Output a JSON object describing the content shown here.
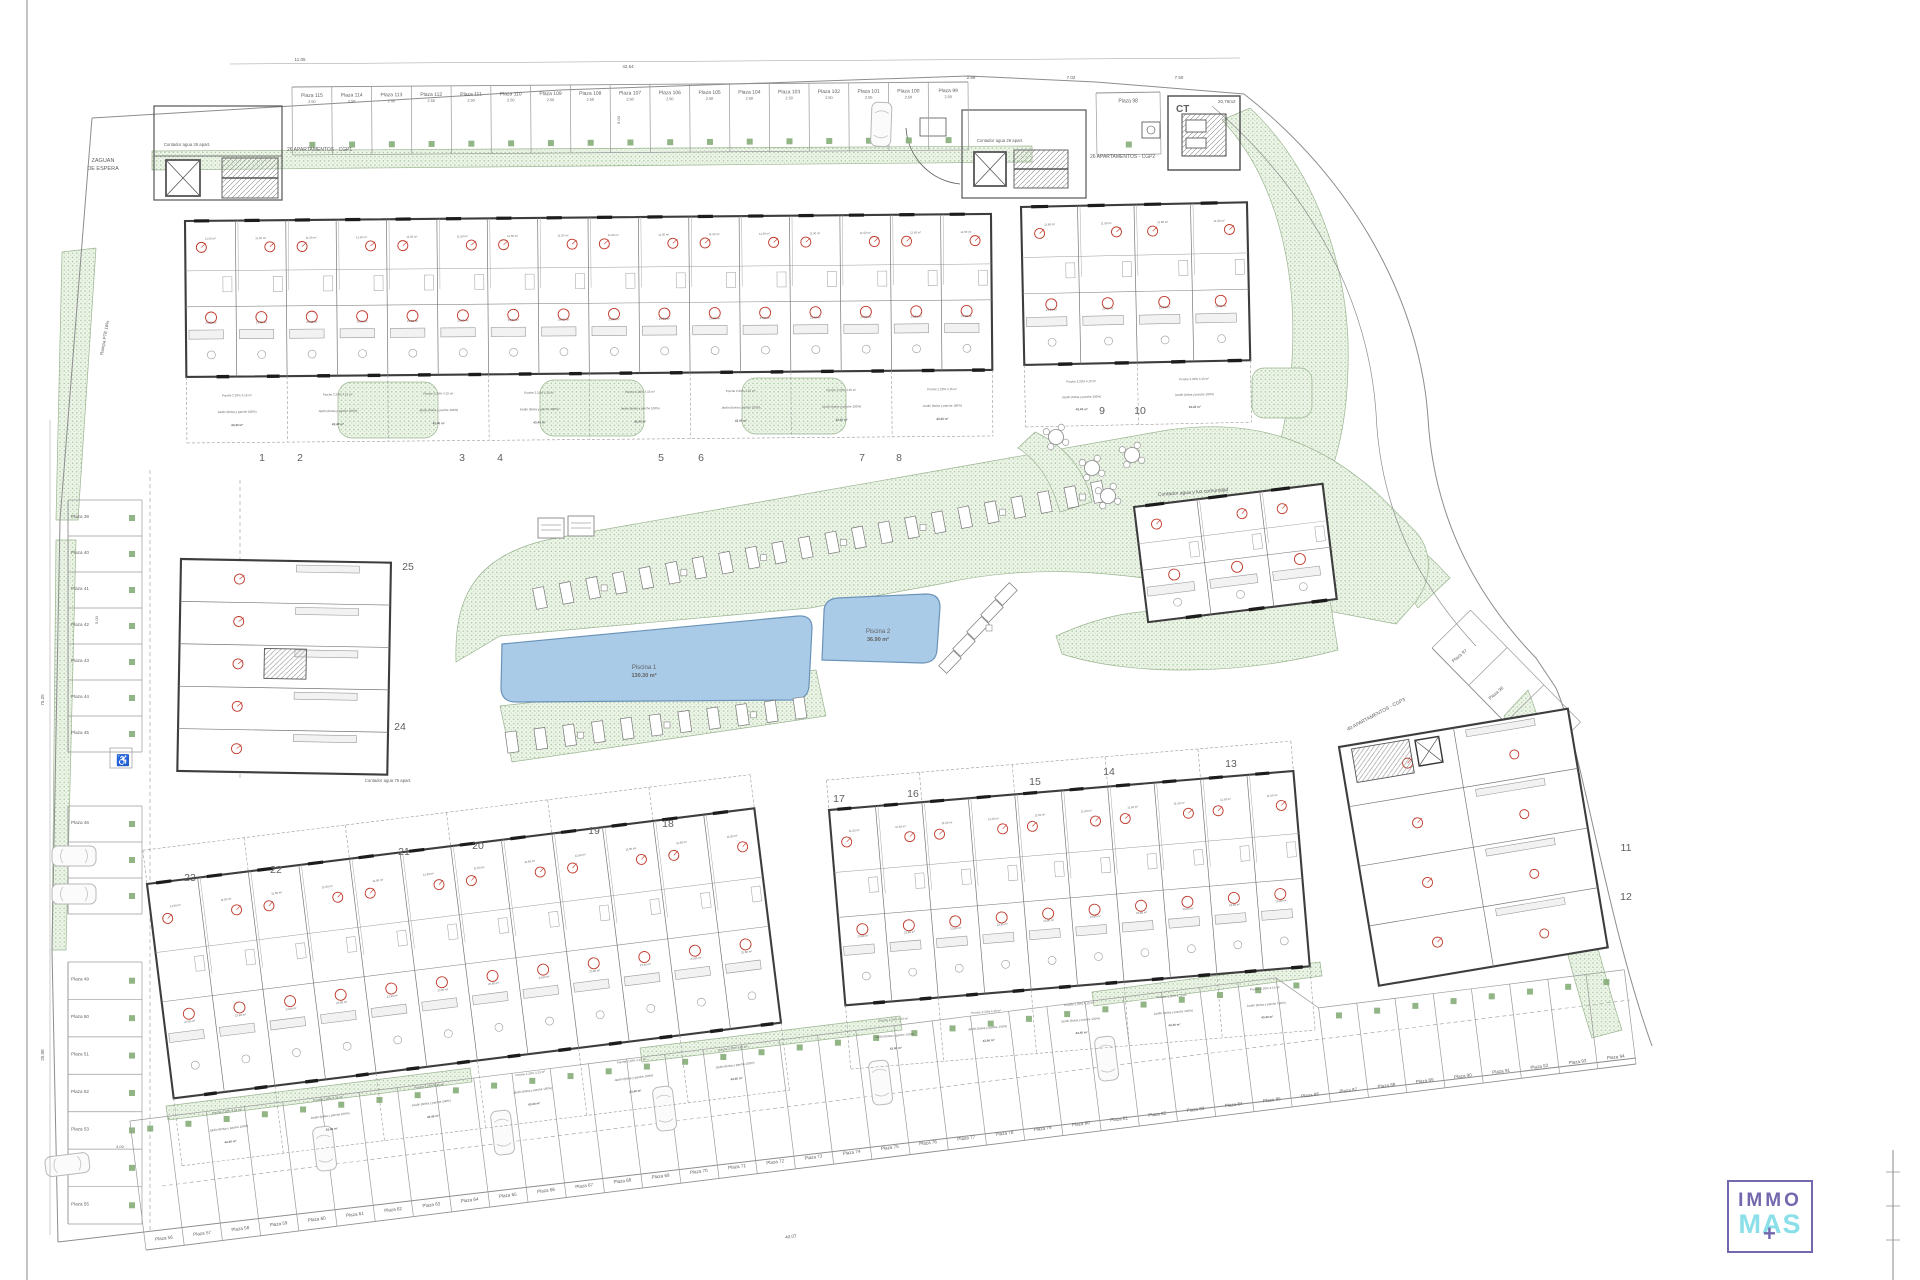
{
  "labels": {
    "zaguan1": "ZAGUAN",
    "zaguan2": "DE ESPERA",
    "contador26": "Contador agua 26 apart.",
    "contador75": "Contador agua 75 apart.",
    "cgp1": "26 APARTAMENTOS - CGP1",
    "cgp2": "26 APARTAMENTOS - CGP2",
    "cgp3": "40 APARTAMENTOS - CGP3",
    "comunidad": "Contador agua y luz comunidad",
    "rampa": "Rampa PTE 16%",
    "ct": "CT",
    "ct_area": "20,76m2"
  },
  "pool1": {
    "name": "Piscina 1",
    "area": "130.30 m²"
  },
  "pool2": {
    "name": "Piscina 2",
    "area": "36.90 m²"
  },
  "parking": {
    "top": [
      "Plaza 115",
      "Plaza 114",
      "Plaza 113",
      "Plaza 112",
      "Plaza 111",
      "Plaza 110",
      "Plaza 109",
      "Plaza 108",
      "Plaza 107",
      "Plaza 106",
      "Plaza 105",
      "Plaza 104",
      "Plaza 103",
      "Plaza 102",
      "Plaza 101",
      "Plaza 100",
      "Plaza 99"
    ],
    "top_right": [
      "Plaza 98"
    ],
    "left1": [
      "Plaza 39",
      "Plaza 40",
      "Plaza 41",
      "Plaza 42",
      "Plaza 43",
      "Plaza 44",
      "Plaza 45"
    ],
    "left2": [
      "Plaza 46",
      "Plaza 47",
      "Plaza 48"
    ],
    "left3": [
      "Plaza 49",
      "Plaza 50",
      "Plaza 51",
      "Plaza 52",
      "Plaza 53",
      "Plaza 54",
      "Plaza 55"
    ],
    "bottom": [
      "Plaza 56",
      "Plaza 57",
      "Plaza 58",
      "Plaza 59",
      "Plaza 60",
      "Plaza 61",
      "Plaza 62",
      "Plaza 63",
      "Plaza 64",
      "Plaza 65",
      "Plaza 66",
      "Plaza 67",
      "Plaza 68",
      "Plaza 69",
      "Plaza 70",
      "Plaza 71",
      "Plaza 72",
      "Plaza 73",
      "Plaza 74",
      "Plaza 75",
      "Plaza 76",
      "Plaza 77",
      "Plaza 78",
      "Plaza 79",
      "Plaza 80",
      "Plaza 81",
      "Plaza 82",
      "Plaza 83",
      "Plaza 84",
      "Plaza 85",
      "Plaza 86",
      "Plaza 87",
      "Plaza 88",
      "Plaza 89",
      "Plaza 90",
      "Plaza 91",
      "Plaza 92",
      "Plaza 93",
      "Plaza 94"
    ],
    "east": [
      "Plaza 97",
      "Plaza 96",
      "Plaza 95"
    ]
  },
  "unit_numbers": {
    "a": [
      "1",
      "2",
      "3",
      "4",
      "5",
      "6",
      "7",
      "8"
    ],
    "b": [
      "9",
      "10"
    ],
    "c": [
      "25",
      "24"
    ],
    "e": [
      "23",
      "22",
      "21",
      "20",
      "19",
      "18"
    ],
    "f": [
      "17",
      "16",
      "15",
      "14",
      "13"
    ],
    "g": [
      "11",
      "12"
    ]
  },
  "unit_texts": {
    "dorm_area": "11.50 m²",
    "salon_area": "23.80 m²",
    "garden": "Jardín (bolsa y parche 100%)",
    "garden_area": "43.40 m²",
    "porche": "Porche 2.20%",
    "porche_area": "4.15 m²"
  },
  "dims": {
    "d1": "11.05",
    "d2": "42.54",
    "d3": "2.89",
    "d4": "7.02",
    "d5": "7.50",
    "d6": "75.25",
    "d7": "25.08",
    "d8": "40.07",
    "d9": "4.00",
    "stall_w": "2.50",
    "stall_d": "5.00"
  },
  "icons": {
    "accessible": "♿"
  },
  "logo": {
    "immo": "IMMO",
    "mas": "MAS",
    "plus": "+"
  },
  "colors": {
    "green": "#a3c49b",
    "pool": "#a9cbe8",
    "wall": "#3d3d3d",
    "red": "#c0392b",
    "brand_purple": "#7268ad",
    "brand_cyan": "#8adfe8"
  }
}
